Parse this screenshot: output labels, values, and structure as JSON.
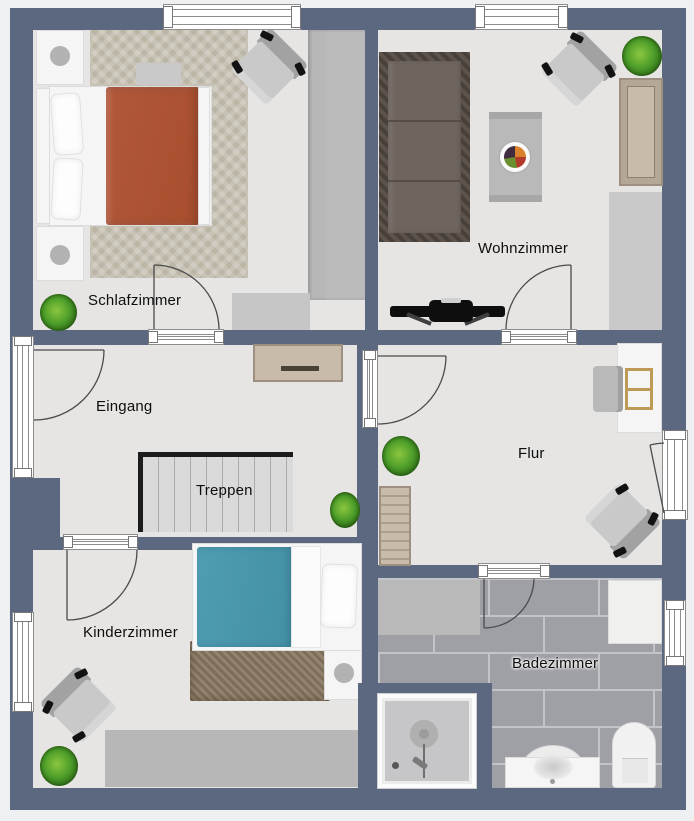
{
  "title": "Floor plan",
  "rooms": {
    "schlafzimmer": {
      "label": "Schlafzimmer"
    },
    "wohnzimmer": {
      "label": "Wohnzimmer"
    },
    "eingang": {
      "label": "Eingang"
    },
    "treppen": {
      "label": "Treppen"
    },
    "flur": {
      "label": "Flur"
    },
    "kinderzimmer": {
      "label": "Kinderzimmer"
    },
    "badezimmer": {
      "label": "Badezimmer"
    }
  },
  "colors": {
    "wall": "#5c6780",
    "floor": "#e6e5e3",
    "tile-base": "#9fa0a6",
    "tile-grout": "#c3c4c8",
    "duvet-master": "#b2583a",
    "duvet-child": "#4f9db3",
    "rug-child": "#8b7a64",
    "carpet": "#c8c2b4",
    "sofa-cushion": "#6e655e",
    "sofa-frame": "#48403a",
    "wood-light": "#c8bba9",
    "stair-black": "#1c1c1c",
    "plant-light": "#8cc63f",
    "plant-mid": "#4d9e2a",
    "plant-dark": "#2e6b16"
  }
}
